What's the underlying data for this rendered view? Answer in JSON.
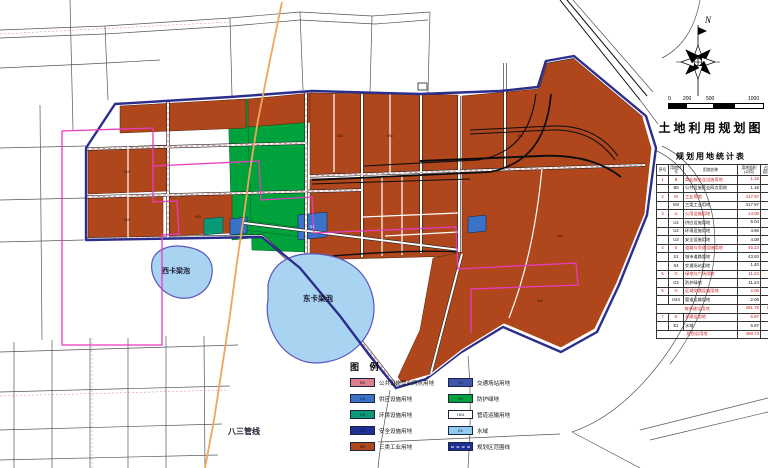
{
  "title": "土地利用规划图",
  "north_label": "N",
  "scale": {
    "ticks": [
      "0",
      "200",
      "500",
      "1000"
    ],
    "unit": "米"
  },
  "map_labels": {
    "west_lake": "西卡梁泡",
    "east_lake": "东卡梁泡",
    "pipeline": "八三管线"
  },
  "parcel_codes": {
    "industrial": "M3",
    "station": "S1"
  },
  "legend": {
    "title": "图 例",
    "left": [
      {
        "code": "B9",
        "label": "公共设施营业网点用地",
        "color": "#dd7f8c"
      },
      {
        "code": "U1",
        "label": "供应设施用地",
        "color": "#3a72c8"
      },
      {
        "code": "U2",
        "label": "环境设施用地",
        "color": "#0a9a78"
      },
      {
        "code": "U3",
        "label": "安全设施用地",
        "color": "#1b2f94"
      },
      {
        "code": "M3",
        "label": "三类工业用地",
        "color": "#b0461c"
      }
    ],
    "right": [
      {
        "code": "S4",
        "label": "交通场站用地",
        "color": "#3f55ae"
      },
      {
        "code": "G2",
        "label": "防护绿地",
        "color": "#00a23c"
      },
      {
        "code": "H24",
        "label": "管道运输用地",
        "color": "#ffffff"
      },
      {
        "code": "E1",
        "label": "水域",
        "color": "#8ecdf0"
      },
      {
        "code": "",
        "label": "规划区范围线",
        "color": "#1b2f94",
        "dash": true
      }
    ]
  },
  "table": {
    "title": "规划用地统计表",
    "headers": [
      "序号",
      "用地代号",
      "用地名称",
      "用地面积(公顷)",
      "占城市建设用地(%)"
    ],
    "rows": [
      {
        "no": "1",
        "code": "B",
        "name": "商业服务业设施用地",
        "area": "1.18",
        "pct": "0.24",
        "red": true
      },
      {
        "no": "",
        "code": "B9",
        "name": "公共设施营业网点用地",
        "area": "1.18",
        "pct": ""
      },
      {
        "no": "2",
        "code": "M",
        "name": "工业用地",
        "area": "417.97",
        "pct": "85.00",
        "red": true
      },
      {
        "no": "",
        "code": "M3",
        "name": "三类工业用地",
        "area": "417.97",
        "pct": ""
      },
      {
        "no": "3",
        "code": "U",
        "name": "公用设施用地",
        "area": "14.08",
        "pct": "2.86",
        "red": true
      },
      {
        "no": "",
        "code": "U1",
        "name": "供应设施用地",
        "area": "5.04",
        "pct": ""
      },
      {
        "no": "",
        "code": "U2",
        "name": "环境设施用地",
        "area": "4.96",
        "pct": ""
      },
      {
        "no": "",
        "code": "U3",
        "name": "安全设施用地",
        "area": "4.08",
        "pct": ""
      },
      {
        "no": "4",
        "code": "S",
        "name": "道路与交通设施用地",
        "area": "45.23",
        "pct": "9.20",
        "red": true
      },
      {
        "no": "",
        "code": "S1",
        "name": "城市道路用地",
        "area": "43.83",
        "pct": ""
      },
      {
        "no": "",
        "code": "S4",
        "name": "交通场站用地",
        "area": "1.40",
        "pct": ""
      },
      {
        "no": "5",
        "code": "G",
        "name": "绿地与广场用地",
        "area": "11.24",
        "pct": "2.28",
        "red": true
      },
      {
        "no": "",
        "code": "G2",
        "name": "防护绿地",
        "area": "11.24",
        "pct": ""
      },
      {
        "no": "6",
        "code": "H",
        "name": "区域交通设施用地",
        "area": "2.06",
        "pct": "0.42",
        "red": true
      },
      {
        "no": "",
        "code": "H24",
        "name": "管道运输用地",
        "area": "2.06",
        "pct": ""
      },
      {
        "span": true,
        "name": "城市建设用地",
        "area": "491.76",
        "pct": "100.00",
        "red": true
      },
      {
        "no": "7",
        "code": "E",
        "name": "非建设用地",
        "area": "6.97",
        "pct": "",
        "red": true
      },
      {
        "no": "",
        "code": "E1",
        "name": "水域",
        "area": "6.97",
        "pct": ""
      },
      {
        "span": true,
        "name": "规划总用地",
        "area": "498.73",
        "pct": "",
        "red": true
      }
    ]
  },
  "colors": {
    "industrial": "#b0461c",
    "protectiveGreen": "#00a23c",
    "envGreen": "#0a9a78",
    "supplyBlue": "#3a72c8",
    "safetyNavy": "#1b2f94",
    "stationBlue": "#3f55ae",
    "commercialPink": "#dd7f8c",
    "water": "#a8d4f2",
    "boundaryNavy": "#2b2e8c",
    "magenta": "#e83cc0",
    "pipelineOrange": "#efa55c",
    "roadRed": "#cc5555",
    "tableRed": "#cc2222"
  }
}
